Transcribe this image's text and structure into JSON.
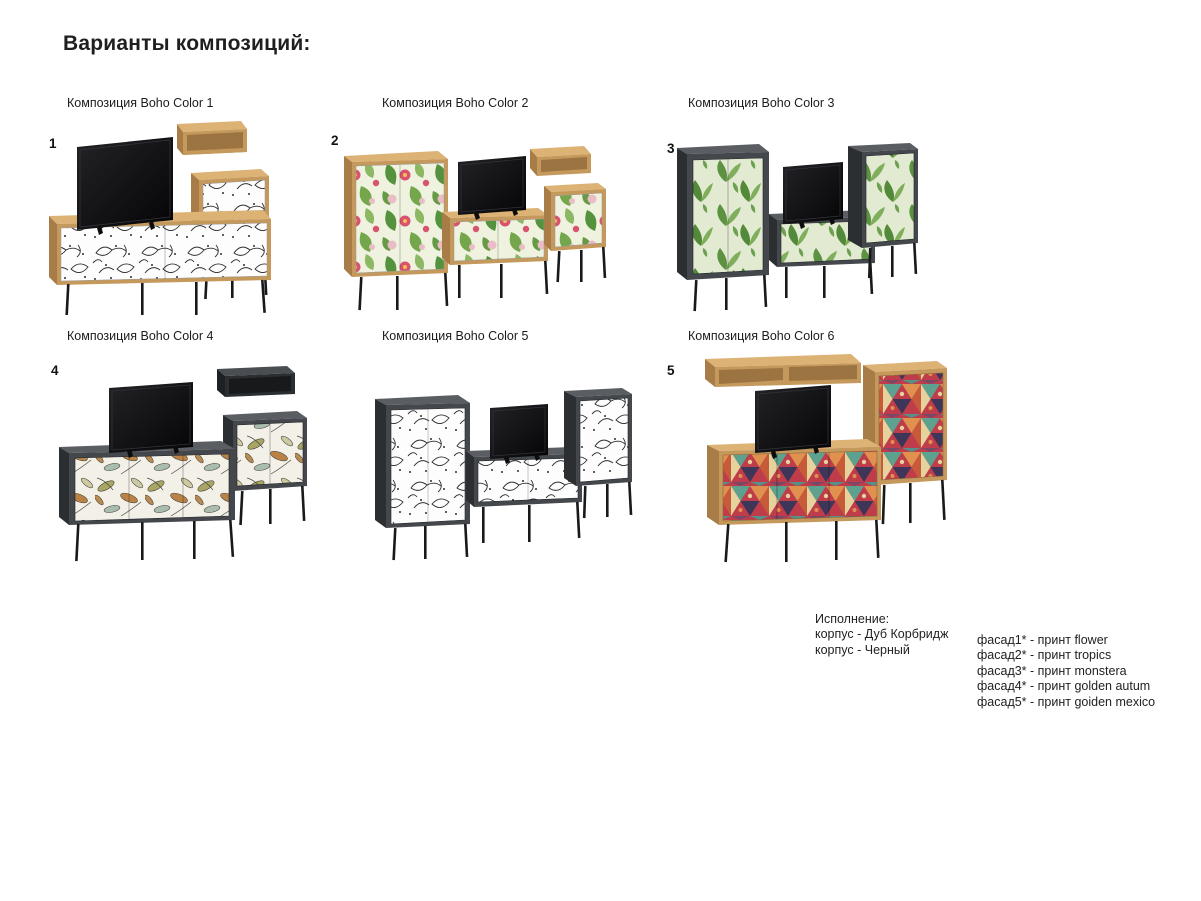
{
  "page": {
    "title": "Варианты композиций:"
  },
  "compositions": [
    {
      "number": "1",
      "label": "Композиция Boho Color 1",
      "print": "flower",
      "body": "Дуб Корбридж"
    },
    {
      "number": "2",
      "label": "Композиция Boho Color 2",
      "print": "tropics",
      "body": "Дуб Корбридж"
    },
    {
      "number": "3",
      "label": "Композиция Boho Color 3",
      "print": "monstera",
      "body": "Черный"
    },
    {
      "number": "4",
      "label": "Композиция Boho Color 4",
      "print": "golden autum",
      "body": "Черный"
    },
    {
      "number": "",
      "label": "Композиция Boho Color 5",
      "print": "flower",
      "body": "Черный"
    },
    {
      "number": "5",
      "label": "Композиция Boho Color 6",
      "print": "goiden mexico",
      "body": "Дуб Корбридж"
    }
  ],
  "legend": {
    "heading": "Исполнение:",
    "body_lines": [
      "корпус - Дуб Корбридж",
      "корпус - Черный"
    ],
    "facade_lines": [
      "фасад1* - принт flower",
      "фасад2* - принт tropics",
      "фасад3* - принт monstera",
      "фасад4* - принт golden autum",
      "фасад5* - принт goiden mexico"
    ]
  },
  "colors": {
    "oak_front": "#c5985c",
    "oak_top": "#dcb275",
    "oak_side": "#a87c46",
    "dark_front": "#44474b",
    "dark_top": "#5a5e63",
    "dark_side": "#2c2f32",
    "leg_black": "#17191b",
    "tv_black": "#0d0d0f"
  }
}
